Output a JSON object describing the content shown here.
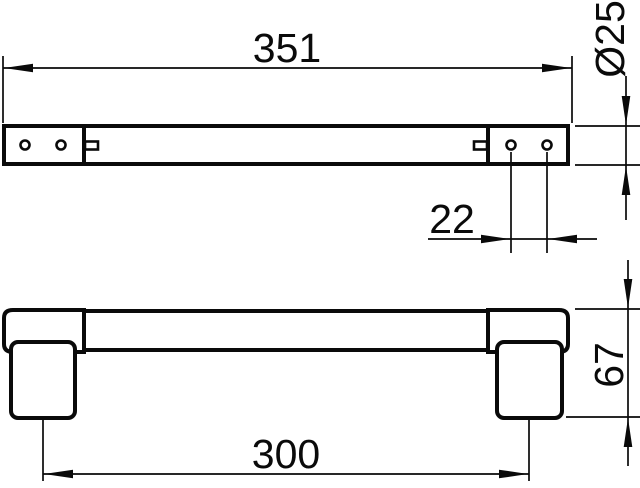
{
  "drawing": {
    "type": "technical-dimension-drawing",
    "background_color": "#ffffff",
    "line_color": "#0a0a0a",
    "views": {
      "top_view": "bar plan view with two mounting plates, four screw holes and two grub-screw slots",
      "front_view": "bar elevation view with two wall posts"
    },
    "dimensions": {
      "overall_length": "351",
      "diameter": "Ø25",
      "hole_spacing": "22",
      "fixing_centers": "300",
      "depth": "67"
    }
  }
}
